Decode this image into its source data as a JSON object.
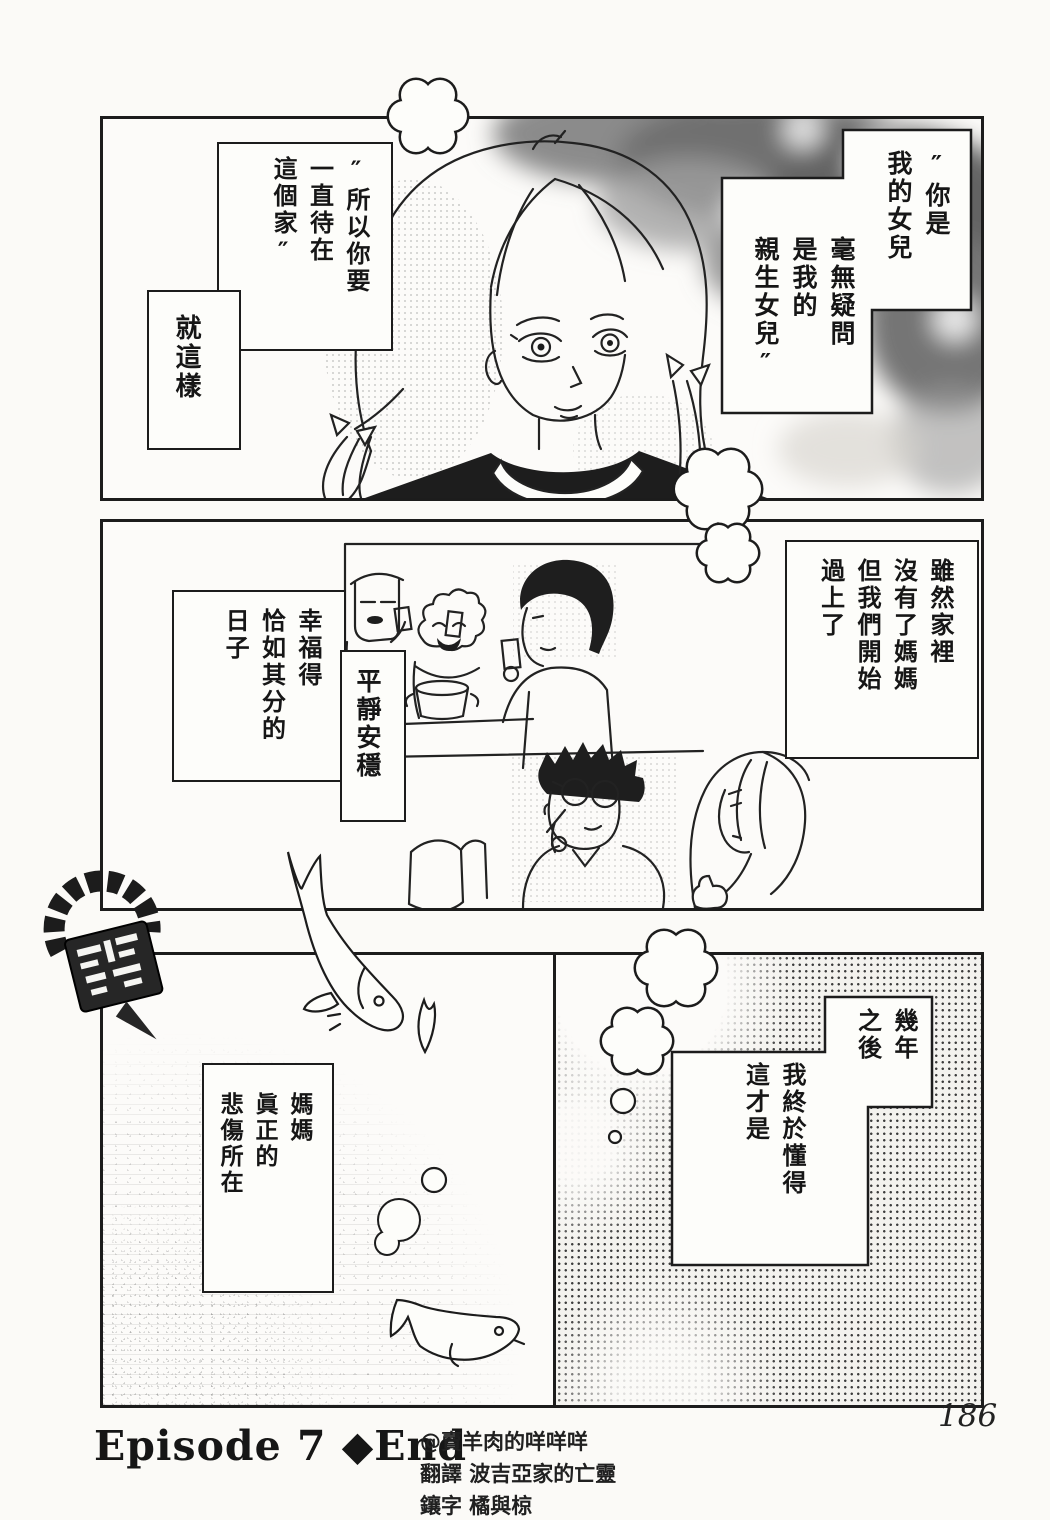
{
  "page": {
    "number": "186"
  },
  "panel1": {
    "balloon_you_are": "″你是\n我的女兒",
    "balloon_no_doubt": "毫無疑問\n是我的\n親生女兒″",
    "balloon_stay": "″所以你要\n一直待在\n這個家″",
    "balloon_just_like_that": "就這樣"
  },
  "panel2": {
    "balloon_although": "雖然家裡\n沒有了媽媽\n但我們開始\n過上了",
    "balloon_happy": "幸福得\n恰如其分的\n日子",
    "balloon_calm": "平靜安穩"
  },
  "panel3": {
    "balloon_mother": "媽媽\n眞正的\n悲傷所在"
  },
  "panel4": {
    "balloon_years": "幾年\n之後",
    "balloon_understand": "我終於懂得\n這才是"
  },
  "footer": {
    "episode_label": "Episode 7 ◆End",
    "credits": [
      "@賣羊肉的咩咩咩",
      "翻譯 波吉亞家的亡靈",
      "鑲字 橘與椋"
    ]
  }
}
